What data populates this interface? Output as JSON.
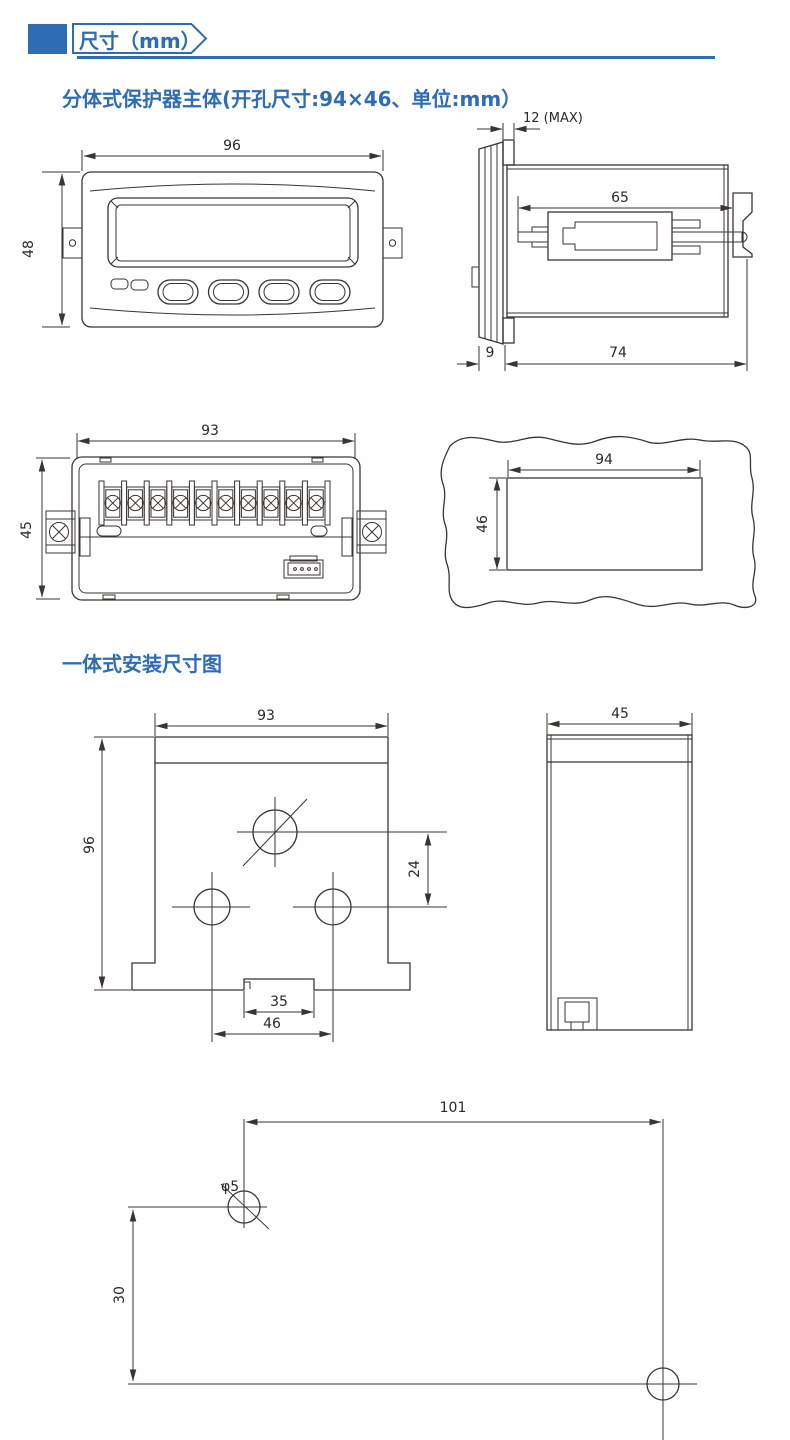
{
  "header": {
    "title": "尺寸（mm）"
  },
  "sections": {
    "split_title": "分体式保护器主体(开孔尺寸:94×46、单位:mm）",
    "integrated_title": "一体式安装尺寸图"
  },
  "figures": {
    "front": {
      "width_mm": "96",
      "height_mm": "48"
    },
    "side": {
      "panel_max": "12 (MAX)",
      "slide_len": "65",
      "bezel_depth": "9",
      "body_depth": "74"
    },
    "rear": {
      "width_mm": "93",
      "height_mm": "45"
    },
    "cutout": {
      "width_mm": "94",
      "height_mm": "46"
    },
    "mount_front": {
      "width_mm": "93",
      "height_mm": "96",
      "offset_mm": "24",
      "slot_mm": "35",
      "span_mm": "46"
    },
    "mount_side": {
      "width_mm": "45"
    },
    "drill": {
      "span_mm": "101",
      "height_mm": "30",
      "hole_dia": "φ5"
    }
  },
  "colors": {
    "accent_blue": "#2e6cb4",
    "line": "#3a3532",
    "text": "#2a2826"
  }
}
